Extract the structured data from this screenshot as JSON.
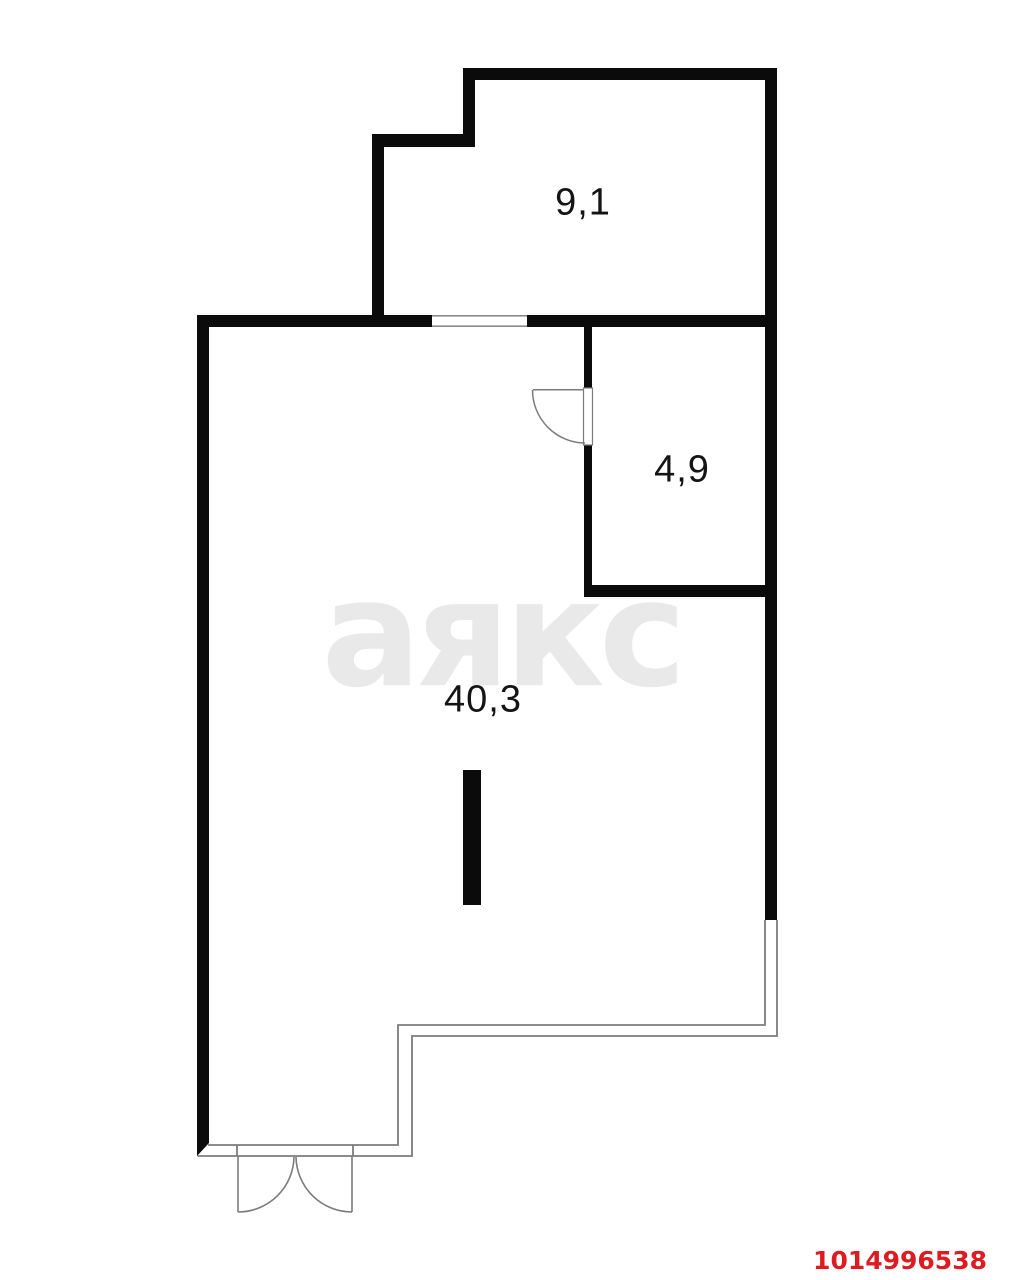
{
  "plan": {
    "watermark": "аякс",
    "listing_id": "1014996538",
    "rooms": [
      {
        "id": "room-1",
        "area_label": "9,1"
      },
      {
        "id": "room-2",
        "area_label": "4,9"
      },
      {
        "id": "room-3",
        "area_label": "40,3"
      }
    ],
    "colors": {
      "wall": "#0b0b0b",
      "thin_line": "#7c7c7c",
      "window_line": "#8a8a8a",
      "watermark": "#e9e9e9",
      "listing_id": "#de1b20",
      "label": "#141414",
      "background": "#ffffff"
    }
  }
}
